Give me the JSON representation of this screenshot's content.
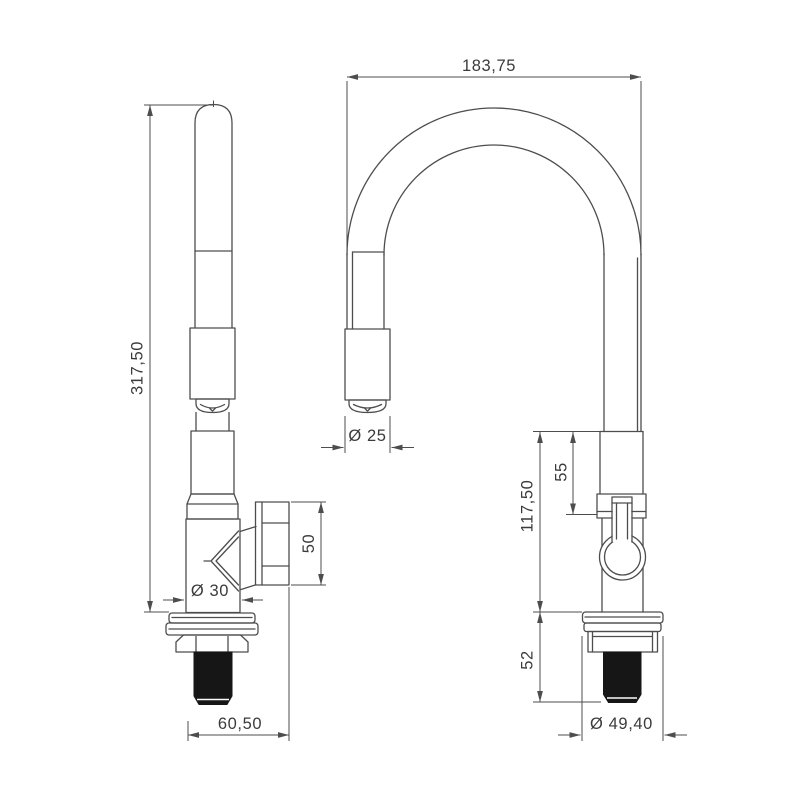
{
  "drawing": {
    "type": "technical-drawing",
    "subject": "kitchen-faucet-two-views",
    "colors": {
      "background": "#ffffff",
      "line": "#4d4d4d",
      "text": "#3b3b3b",
      "thread_fill": "#161616"
    },
    "side_view": {
      "dims": {
        "overall_height": "317,50",
        "handle_height": "50",
        "body_diameter": "Ø 30",
        "base_depth": "60,50"
      }
    },
    "front_view": {
      "dims": {
        "spout_reach": "183,75",
        "spout_tip_diameter": "Ø 25",
        "neck_to_handle": "55",
        "hose_to_deck": "117,50",
        "under_deck": "52",
        "flange_diameter": "Ø 49,40"
      }
    }
  }
}
